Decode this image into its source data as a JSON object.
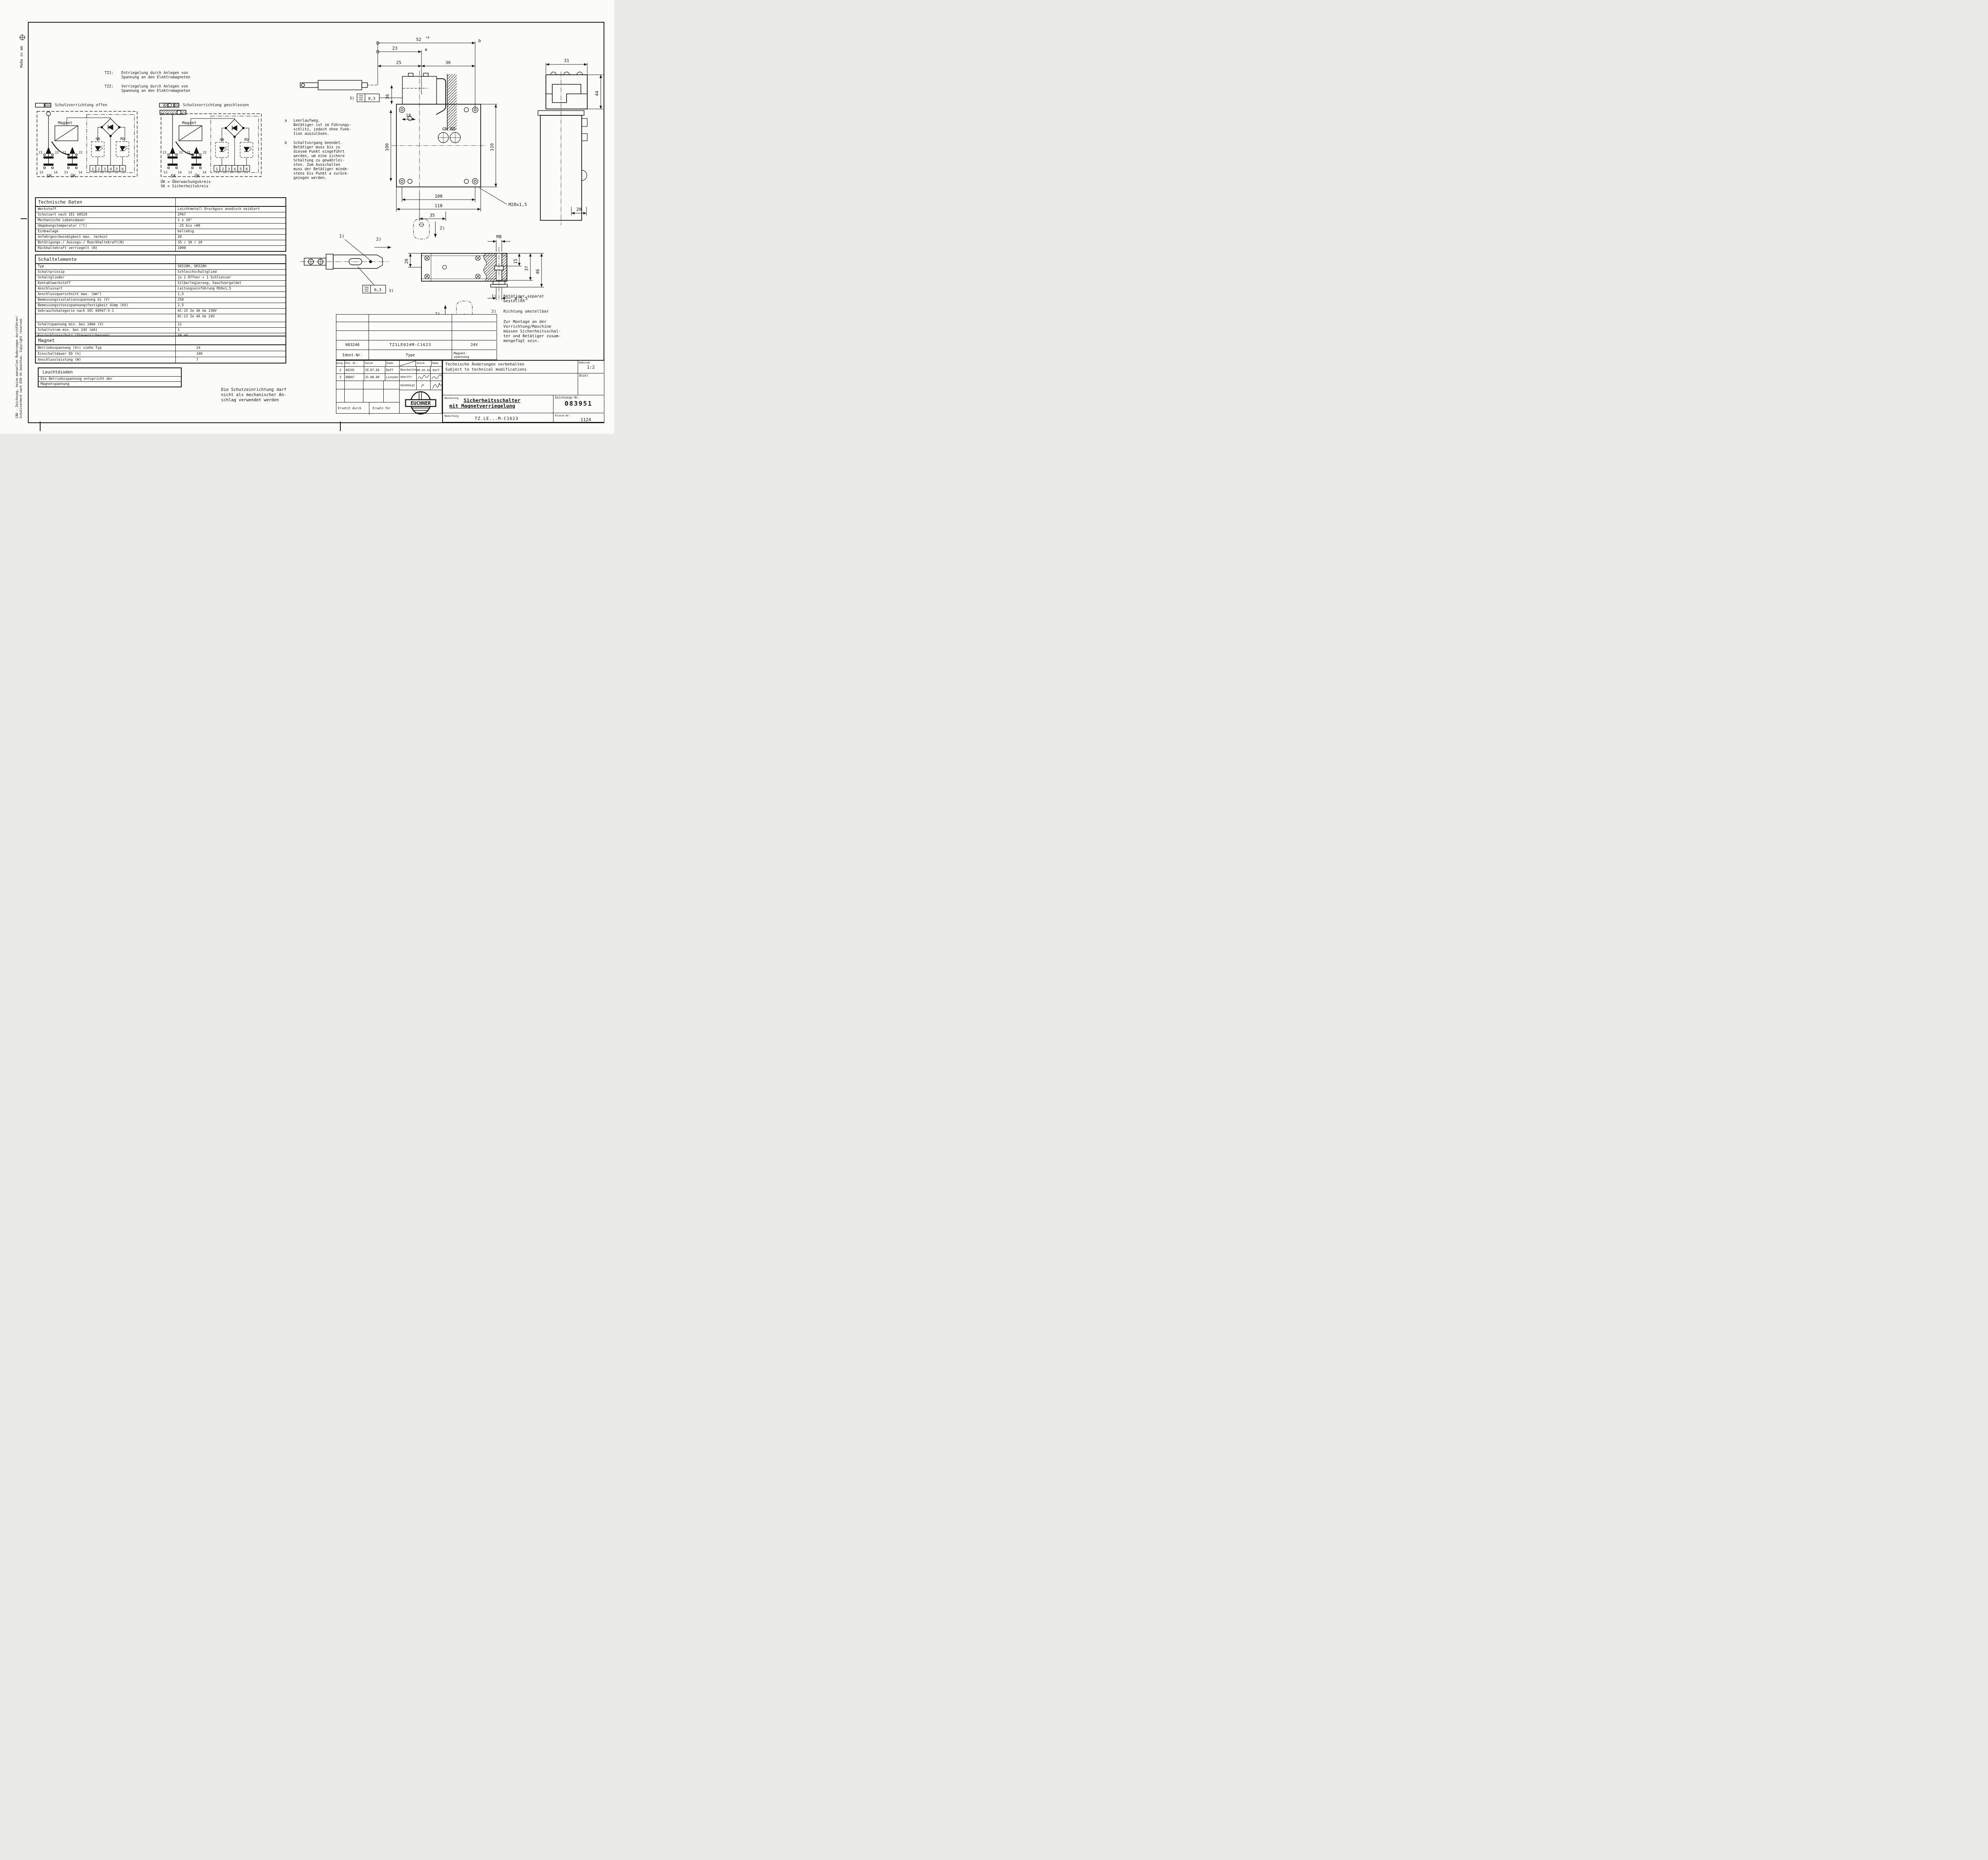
{
  "sheet": {
    "masse": "Maße in mm",
    "cad_note_line1": "CAD - Zeichnung, keine manuellen Änderungen durchführen!",
    "cad_note_line2": "Schutzvermerk nach DIN 34 beachten. Copyright reserved."
  },
  "tz_notes": {
    "tz1_label": "TZ1:",
    "tz1_text": "Entriegelung durch Anlegen von\nSpannung an den Elektromagneten",
    "tz2_label": "TZ2:",
    "tz2_text": "Verriegelung durch Anlegen von\nSpannung an den Elektromagneten"
  },
  "circuits": {
    "open_title": "Schutzvorrichtung offen",
    "closed_title": "Schutzvorrichtung geschlossen",
    "labels": {
      "magnet": "Magnet",
      "c21": "21",
      "c22": "22",
      "c13": "13",
      "c14": "14",
      "sk": "SK",
      "uk": "ÜK",
      "gn": "GN",
      "rd": "RD",
      "t1": "1",
      "t2": "2",
      "t3": "3",
      "t4": "4",
      "t5": "5",
      "t6": "6"
    },
    "legend_uk": "ÜK = Überwachungskreis",
    "legend_sk": "SK = Sicherheitskreis"
  },
  "tech_table": {
    "title": "Technische Daten",
    "rows": [
      {
        "label": "Werkstoff",
        "value": "Leichtmetall Druckguss anodisch oxidiert"
      },
      {
        "label": "Schutzart nach IEC 60529",
        "value": "IP67"
      },
      {
        "label": "Mechanische Lebensdauer",
        "value": "1 x 10⁶"
      },
      {
        "label": "Umgebungstemperatur (°C)",
        "value": "-25 bis +80"
      },
      {
        "label": "Einbaulage",
        "value": "beliebig"
      },
      {
        "label": "Anfahrgeschwindigkeit max. (m/min)",
        "value": "20"
      },
      {
        "label": "Betätigungs-/ Auszugs-/ Rueckhaltekraft(N)",
        "value": "35 / 30 / 10"
      },
      {
        "label": "Rückhaltekraft verriegelt (N)",
        "value": "1000"
      }
    ]
  },
  "switch_table": {
    "title": "Schaltelemente",
    "rows_a": [
      {
        "label": "Typ",
        "value": "SK528H, ÜK528H"
      },
      {
        "label": "Schaltprinzip",
        "value": "Schleichschaltglied"
      },
      {
        "label": "Schaltglieder",
        "value": "je 1 Öffner + 1 Schliesser"
      },
      {
        "label": "Kontaktwerkstoff",
        "value": "Silberlegierung, hauchvergoldet"
      },
      {
        "label": "Anschlussart",
        "value": "Leitungseinführung M20x1,5"
      },
      {
        "label": "Anschlussquerschnitt max. (mm²)",
        "value": "1,5"
      },
      {
        "label": "Bemessungsisolationsspannung Ui (V)",
        "value": "250"
      },
      {
        "label": "Bemessungsstossspannungsfestigkeit Uimp (kV)",
        "value": "2,5"
      },
      {
        "label": "Gebrauchskategorie nach IEC 60947-5-1",
        "value": "AC-15 Ie 4A  Ue 230V"
      },
      {
        "label": "",
        "value": "DC-13 Ie 4A  Ue 24V"
      }
    ],
    "rows_b": [
      {
        "label": "Schaltspannung min. bei 10mA (V)",
        "value": "12"
      },
      {
        "label": "Schaltstrom min. bei 24V (mA)",
        "value": "1"
      },
      {
        "label": "Kurzschlussschutz (Steuersicherung)",
        "value": "4A gG"
      }
    ]
  },
  "magnet_table": {
    "title": "Magnet",
    "rows": [
      {
        "label": "Betriebsspannung (V≂) siehe Typ",
        "value": "24"
      },
      {
        "label": "Einschaltdauer ED (%)",
        "value": "100"
      },
      {
        "label": "Anschlussleistung (W)",
        "value": "7"
      }
    ]
  },
  "led_box": {
    "title": "Leuchtdioden",
    "line1": "Die Betriebsspannung entspricht der",
    "line2": "Magnetspannung"
  },
  "warning_text": "Die Schutzeinrichtung darf\nnicht als mechanischer An-\nschlag verwendet werden",
  "notes_ab": {
    "a_label": "a",
    "a_text": "Leerlaufweg.\nBetätiger ist im Führungs-\nschlitz, jedoch ohne Funk-\ntion auszulösen.",
    "b_label": "b",
    "b_text": "Schaltvorgang beendet.\nBetätiger muss bis zu\ndiesem Punkt eingeführt\nwerden, um eine sichere\nSchaltung zu gewährlei-\nsten. Zum Ausschalten\nmuss der Betätiger minde-\nstens bis Punkt a zurück-\ngezogen werden."
  },
  "notes_num": [
    {
      "num": "1)",
      "text": "Betätiger separat\nbestellen"
    },
    {
      "num": "2)",
      "text": "Richtung umstellbar"
    },
    {
      "num": "3)",
      "text": "Zur Montage an der\nVorrichtung/Maschine\nmüssen Sicherheitsschal-\nter und Betätiger zusam-\nmengefügt sein."
    }
  ],
  "dims_top": {
    "d52": "52",
    "d52_tol": "+4",
    "b": "b",
    "d23": "23",
    "a": "a",
    "d25": "25",
    "d36h": "36",
    "d36v": "36",
    "note3": "3)",
    "flat": "0,3",
    "d18": "18",
    "d100l": "100",
    "d110r": "110",
    "gn_rd": "GN RD",
    "m20": "M20x1,5",
    "d100b": "100",
    "d110b": "110",
    "d35": "35"
  },
  "dims_side": {
    "d31": "31",
    "d44": "44",
    "d20": "20"
  },
  "dims_plan": {
    "note1": "1)",
    "note2a": "2)",
    "note2b": "2)",
    "note2c": "2)",
    "d20": "20",
    "flat": "0,3",
    "note3": "3)",
    "m8": "M8",
    "d15": "15",
    "d37": "37",
    "d46": "46",
    "dia": "ø 5,5"
  },
  "titleblock": {
    "ident_value": "083246",
    "type_value": "TZ1LE024M-C1623",
    "voltage_value": "24V",
    "ident_label": "Ident-Nr.",
    "type_label": "Type",
    "voltage_label": "Magnet-\nspannung",
    "rev_ausg": "Ausg.",
    "rev_aend": "Änd.-Nr.",
    "rev_datum": "Datum",
    "rev_name": "Name",
    "revisions": [
      {
        "ausg": "2",
        "nr": "04245",
        "datum": "19.07.04",
        "name": "Raff"
      },
      {
        "ausg": "3",
        "nr": "08847",
        "datum": "31.08.09",
        "name": "Linsner"
      }
    ],
    "bearbeitet": "Bearbeitet",
    "bearbeitet_datum": "06.02.01",
    "bearbeitet_name": "Raff",
    "geprueft": "Geprüft",
    "genehmigt": "Genehmigt",
    "appr_datum": "Datum",
    "appr_name": "Name",
    "ersetzt": "Ersetzt durch",
    "ersatz": "Ersatz für",
    "logo": "EUCHNER",
    "tech_note_de": "Technische Änderungen vorbehalten",
    "tech_note_en": "Subject to technical modifications",
    "massstab_label": "Maßstab",
    "massstab_value": "1:2",
    "blatt_label": "Blatt",
    "benennung_label": "Benennung",
    "benennung_line1": "Sicherheitsschalter",
    "benennung_line2": "mit Magnetverriegelung",
    "zeichnung_label": "Zeichnungs-Nr.",
    "zeichnung_value": "083951",
    "bemerkung_label": "Bemerkung",
    "bemerkung_value": "TZ.LE...M-C1623",
    "klasse_label": "Klasse-Nr.",
    "klasse_value": "1124"
  }
}
